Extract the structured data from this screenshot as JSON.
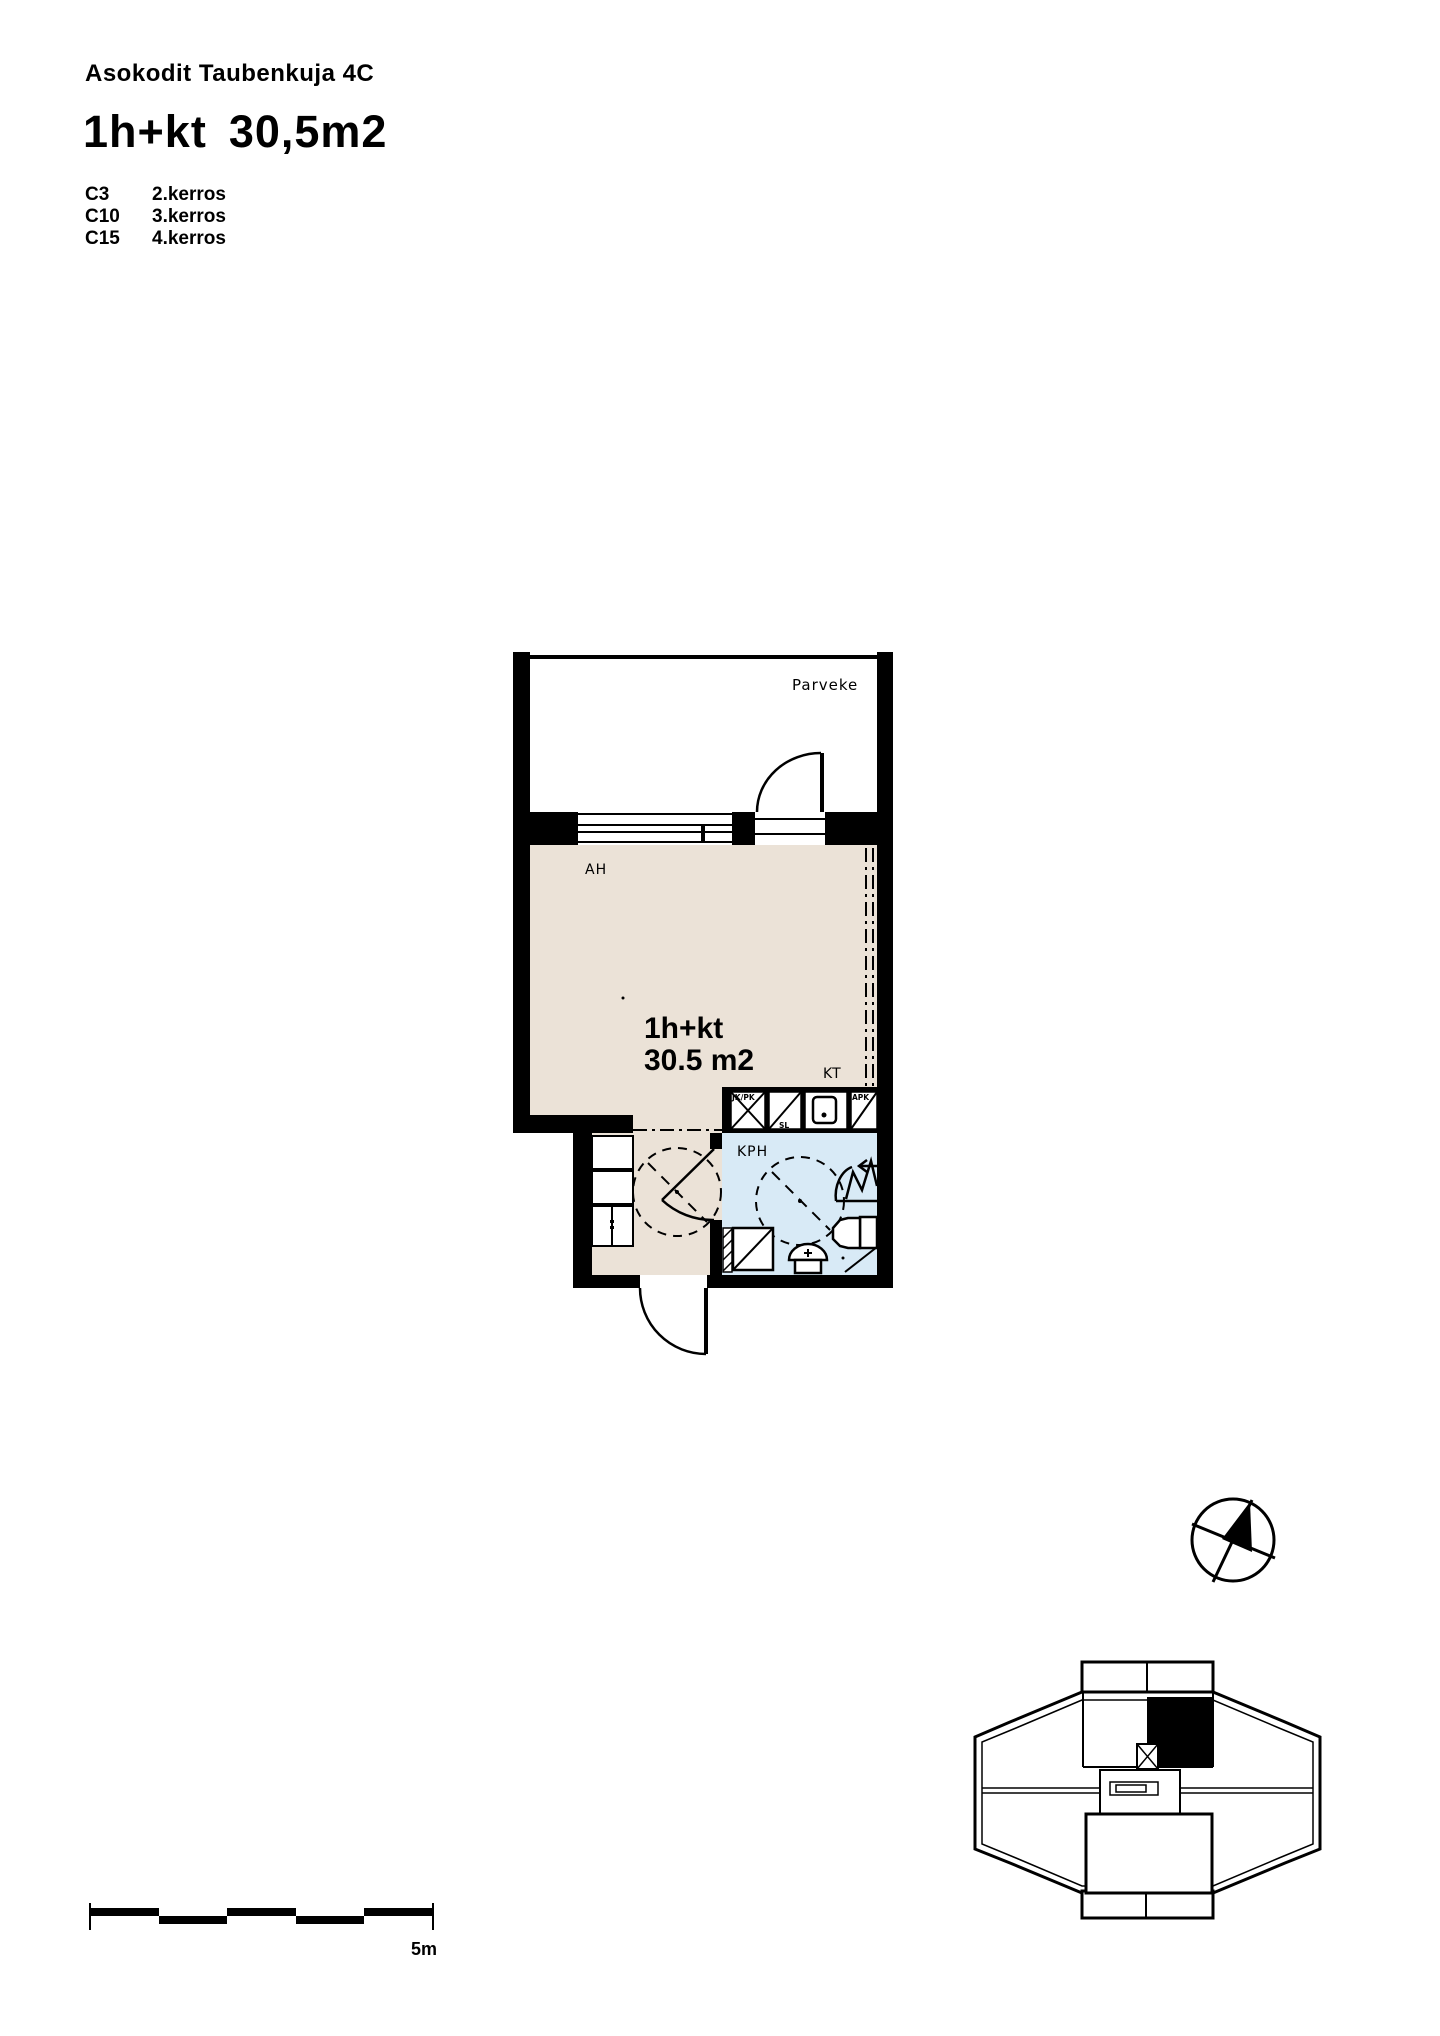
{
  "header": {
    "building": "Asokodit Taubenkuja 4C",
    "type": "1h+kt",
    "area": "30,5m2",
    "units": [
      {
        "code": "C3",
        "floor": "2.kerros"
      },
      {
        "code": "C10",
        "floor": "3.kerros"
      },
      {
        "code": "C15",
        "floor": "4.kerros"
      }
    ]
  },
  "plan": {
    "balcony_label": "Parveke",
    "living_room_label": "AH",
    "unit_type": "1h+kt",
    "unit_area": "30.5 m2",
    "kitchenette_label": "KT",
    "bathroom_label": "KPH",
    "appliances": {
      "fridge_freezer": "JK/PK",
      "stove": "SL",
      "dishwasher": "APK"
    }
  },
  "scale": {
    "label": "5m"
  },
  "colors": {
    "wall": "#000000",
    "floor": "#ebe2d7",
    "wet_floor": "#d8eaf6",
    "background": "#ffffff"
  }
}
